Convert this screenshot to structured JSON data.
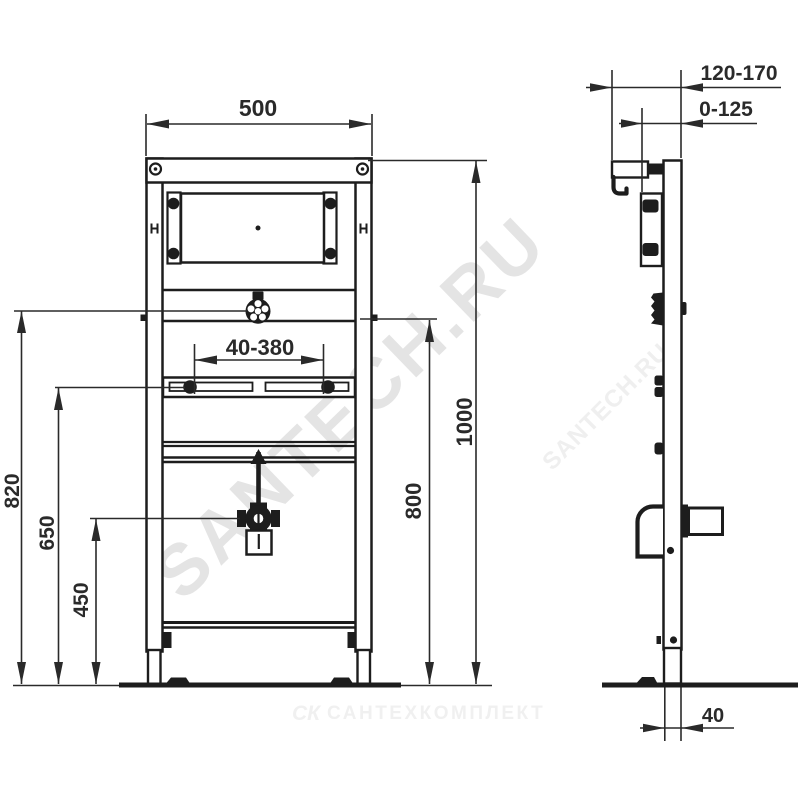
{
  "dims": {
    "front": {
      "width": "500",
      "overall_height": "1000",
      "tap_rail_height": "800",
      "left_top_height": "820",
      "slot_rail_height": "650",
      "drain_height": "450",
      "slot_adjust_range": "40-380"
    },
    "side": {
      "wall_offset_range": "120-170",
      "adjust_range": "0-125",
      "foot_depth": "40"
    }
  },
  "watermarks": {
    "diagonal_main": "SANTECH.RU",
    "diagonal_small": "SANTECH.RU",
    "bottom_logo": "СК",
    "bottom_text": "САНТЕХКОМПЛЕКТ"
  },
  "colors": {
    "background": "#ffffff",
    "line": "#1d1d1d",
    "dimension_text": "#2a2a2a",
    "watermark_main": "#e4e4e4",
    "watermark_small": "#efefef",
    "watermark_footer": "#f0f0f0"
  }
}
